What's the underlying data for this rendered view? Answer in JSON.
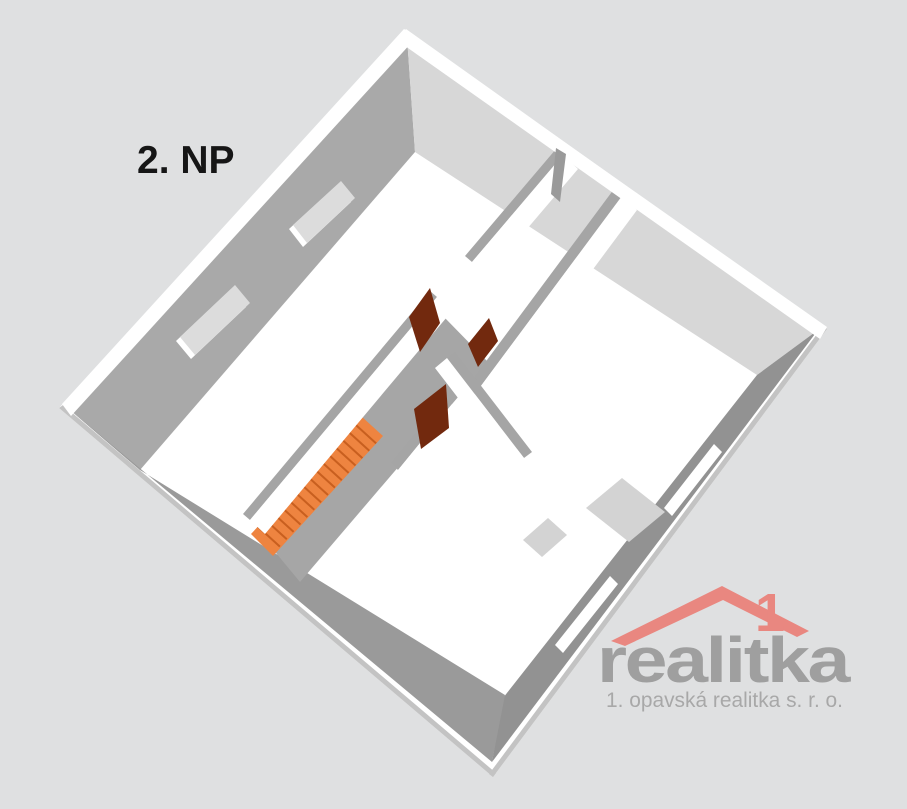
{
  "floor_label": "2. NP",
  "watermark": {
    "brand": "realitka",
    "chimney_digit": "1",
    "tagline": "1. opavská realitka s. r. o."
  },
  "palette": {
    "background": "#dfe0e1",
    "wall_top": "#ffffff",
    "wall_far_face": "#a9a9a9",
    "wall_ne_face": "#d7d7d7",
    "wall_se_face": "#929292",
    "wall_sw_face": "#9a9a9a",
    "partition_shadow": "#a5a5a5",
    "edge_sliver": "#c3c3c3",
    "floor": "#ffffff",
    "stairwell_floor": "#a6a6a6",
    "landing": "#d3d3d3",
    "window_opening": "#dcdcdc",
    "stairs": "#ee8440",
    "stair_riser": "#c85f1f",
    "door": "#72290e",
    "brand_red": "#ea837b",
    "brand_gray": "#9c9c9c",
    "tagline_gray": "#a6a6a6",
    "label_color": "#161616"
  },
  "plan_summary": {
    "floor": "2. NP",
    "visible_doors": 3,
    "back_wall_windows": 2,
    "front_wall_window_slits": 2,
    "staircase_steps": 16
  }
}
